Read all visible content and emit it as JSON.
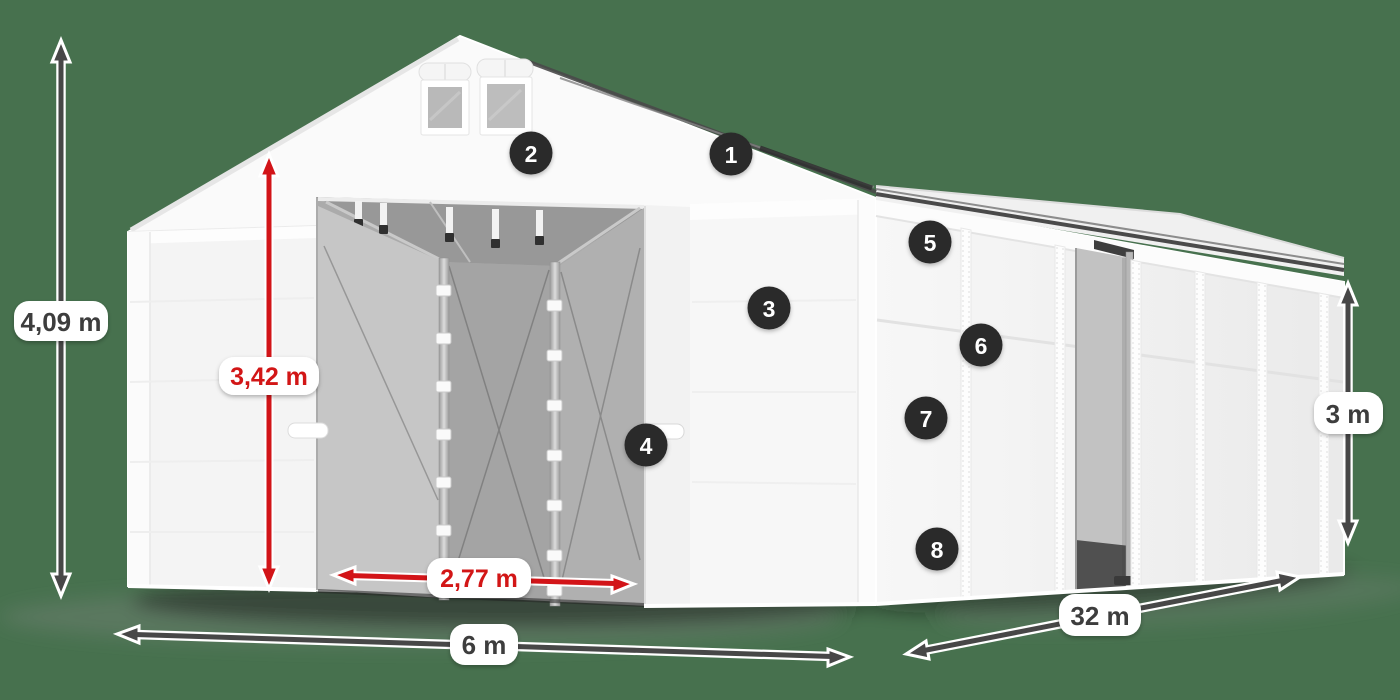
{
  "colors": {
    "background": "#47714e",
    "arrow_dark": "#474747",
    "accent_red": "#d21418",
    "badge_bg": "#2b2b2b",
    "badge_text": "#ffffff",
    "label_bg": "#ffffff",
    "label_text": "#3c3c3c"
  },
  "dimensions": {
    "total_height": {
      "label": "4,09 m"
    },
    "clear_height": {
      "label": "3,42 m"
    },
    "door_width": {
      "label": "2,77 m"
    },
    "width": {
      "label": "6 m"
    },
    "length": {
      "label": "32 m"
    },
    "side_height": {
      "label": "3 m"
    }
  },
  "markers": [
    {
      "number": "1"
    },
    {
      "number": "2"
    },
    {
      "number": "3"
    },
    {
      "number": "4"
    },
    {
      "number": "5"
    },
    {
      "number": "6"
    },
    {
      "number": "7"
    },
    {
      "number": "8"
    }
  ]
}
